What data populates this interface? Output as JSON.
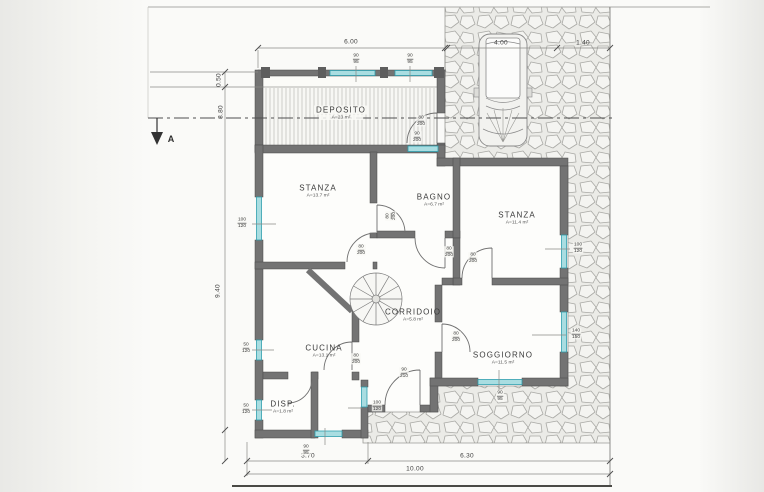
{
  "drawing": {
    "section_label": "A",
    "rooms": [
      {
        "name": "DEPOSITO",
        "area": "A=23 m²"
      },
      {
        "name": "STANZA",
        "area": "A=13.7 m²"
      },
      {
        "name": "BAGNO",
        "area": "A=6.7 m²"
      },
      {
        "name": "STANZA",
        "area": "A=11.4 m²"
      },
      {
        "name": "CORRIDOIO",
        "area": "A=5.8 m²"
      },
      {
        "name": "CUCINA",
        "area": "A=13.1 m²"
      },
      {
        "name": "DISP.",
        "area": "A=1.8 m²"
      },
      {
        "name": "SOGGIORNO",
        "area": "A=11.5 m²"
      }
    ],
    "dimensions": [
      {
        "id": "deposito-width",
        "value": "6.00"
      },
      {
        "id": "carport-width",
        "value": "4.00"
      },
      {
        "id": "side-strip-width",
        "value": "1.40"
      },
      {
        "id": "canopy-offset",
        "value": "0.50"
      },
      {
        "id": "left-inner-height",
        "value": "8.80"
      },
      {
        "id": "left-total-height",
        "value": "9.40"
      },
      {
        "id": "bottom-left-width",
        "value": "3.70"
      },
      {
        "id": "bottom-right-width",
        "value": "6.30"
      },
      {
        "id": "bottom-total-width",
        "value": "10.00"
      }
    ],
    "openings": [
      {
        "w": "90",
        "h": "95"
      },
      {
        "w": "90",
        "h": "95"
      },
      {
        "w": "80",
        "h": "200"
      },
      {
        "w": "90",
        "h": "200"
      },
      {
        "w": "100",
        "h": "120"
      },
      {
        "w": "80",
        "h": "200"
      },
      {
        "w": "80",
        "h": "200"
      },
      {
        "w": "80",
        "h": "200"
      },
      {
        "w": "80",
        "h": "200"
      },
      {
        "w": "100",
        "h": "120"
      },
      {
        "w": "80",
        "h": "200"
      },
      {
        "w": "80",
        "h": "200"
      },
      {
        "w": "50",
        "h": "120"
      },
      {
        "w": "90",
        "h": "210"
      },
      {
        "w": "100",
        "h": "120"
      },
      {
        "w": "50",
        "h": "120"
      },
      {
        "w": "140",
        "h": "150"
      },
      {
        "w": "90",
        "h": "95"
      },
      {
        "w": "90",
        "h": "95"
      }
    ],
    "colors": {
      "wall": "#737373",
      "window_glass": "#a9dde1",
      "window_frame": "#2f9fae",
      "paper": "#fafaf8",
      "line": "#555555"
    }
  }
}
